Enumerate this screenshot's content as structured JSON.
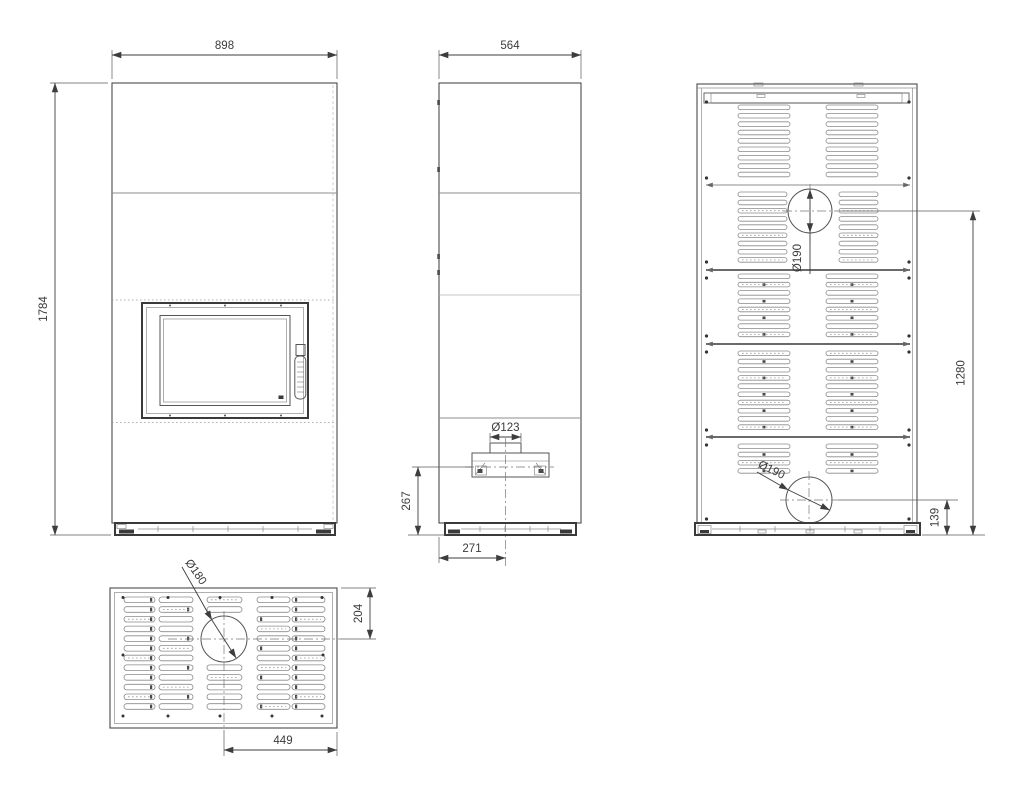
{
  "colors": {
    "background": "#ffffff",
    "line": "#4a4a4a",
    "dimension_text": "#3b3b3b"
  },
  "labels": {
    "front": {
      "width": "898",
      "height": "1784"
    },
    "side": {
      "width": "564",
      "inlet_diameter": "Ø123",
      "inlet_height": "267",
      "inlet_offset": "271"
    },
    "back": {
      "upper_outlet_diameter": "Ø190",
      "upper_outlet_height": "1280",
      "rear_outlet_diameter": "Ø190",
      "rear_outlet_height": "139"
    },
    "top": {
      "outlet_diameter": "Ø180",
      "outlet_from_back": "204",
      "outlet_from_side": "449"
    }
  }
}
